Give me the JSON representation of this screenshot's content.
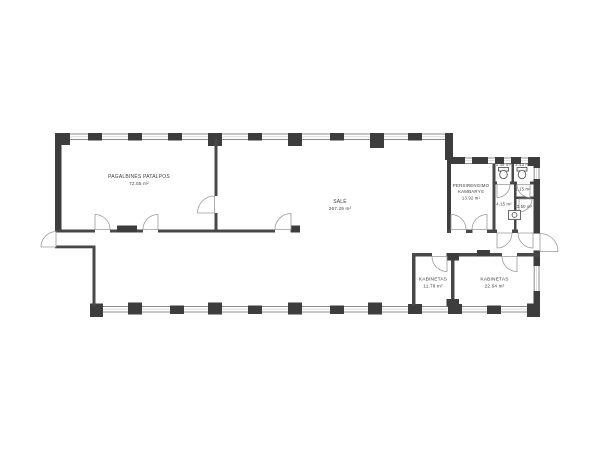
{
  "plan": {
    "title": "floor-plan",
    "rooms": [
      {
        "id": "pagalbines-patalpos",
        "name": "PAGALBINĖS PATALPOS",
        "area": "72.55 m²"
      },
      {
        "id": "sale",
        "name": "SALĖ",
        "area": "267.29 m²"
      },
      {
        "id": "persirengimo-kambarys",
        "name_line1": "PERSIRENGIMO",
        "name_line2": "KAMBARYS",
        "area": "13.92 m²"
      },
      {
        "id": "wc-1",
        "area": "1.46 m²"
      },
      {
        "id": "wc-2",
        "area": "2.43 m²"
      },
      {
        "id": "patalpa-115",
        "area": "1.15 m²"
      },
      {
        "id": "patalpa-415",
        "area": "4.15 m²"
      },
      {
        "id": "patalpa-350",
        "area": "3.50 m²"
      },
      {
        "id": "kabinetas-1",
        "name": "KABINETAS",
        "area": "11.78 m²"
      },
      {
        "id": "kabinetas-2",
        "name": "KABINETAS",
        "area": "22.64 m²"
      }
    ],
    "colors": {
      "wall": "#3d3d3d",
      "interior_wall": "#484848",
      "window_line": "#8c8c8c",
      "door_arc": "#9a9a9a",
      "label": "#3c3c3c",
      "background": "#ffffff"
    }
  }
}
